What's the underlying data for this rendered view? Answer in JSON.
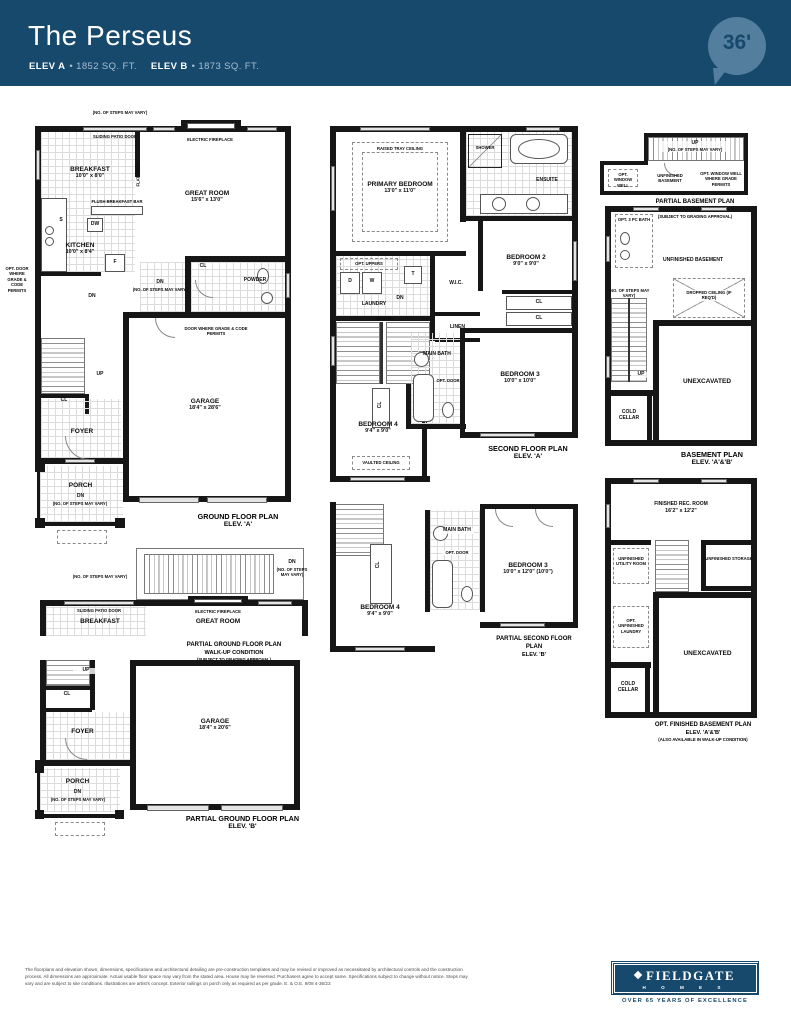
{
  "header": {
    "title": "The Perseus",
    "elev_a_label": "ELEV A",
    "elev_a_value": "• 1852 SQ. FT.",
    "elev_b_label": "ELEV B",
    "elev_b_value": "• 1873 SQ. FT.",
    "lot_badge": "36'"
  },
  "plans": {
    "ground_a": {
      "caption": [
        "GROUND FLOOR PLAN",
        "ELEV. 'A'"
      ],
      "labels": {
        "steps_note_top": "(NO. OF STEPS MAY VARY)",
        "sliding_patio_door": "SLIDING PATIO DOOR",
        "electric_fireplace": "ELECTRIC FIREPLACE",
        "breakfast_name": "BREAKFAST",
        "breakfast_dims": "10'0\" x 8'0\"",
        "flat_arch": "FLAT ARCH",
        "great_room_name": "GREAT ROOM",
        "great_room_dims": "15'6\" x 13'0\"",
        "flush_breakfast_bar": "FLUSH BREAKFAST BAR",
        "dw": "DW",
        "sink": "S",
        "fridge": "F",
        "kitchen_name": "KITCHEN",
        "kitchen_dims": "10'0\" x 8'4\"",
        "opt_door_note": "OPT. DOOR WHERE GRADE & CODE PERMITS",
        "closet_powder": "CL",
        "powder": "POWDER",
        "dn_mid": "DN",
        "dn_mid_note": "(NO. OF STEPS MAY VARY)",
        "garage_door_note": "DOOR WHERE GRADE & CODE PERMITS",
        "dn_stairs": "DN",
        "up_stairs": "UP",
        "closet_foyer": "CL",
        "foyer": "FOYER",
        "garage_name": "GARAGE",
        "garage_dims": "18'4\" x 28'6\"",
        "porch": "PORCH",
        "porch_dn": "DN",
        "porch_dn_note": "(NO. OF STEPS MAY VARY)"
      }
    },
    "second_a": {
      "caption": [
        "SECOND FLOOR PLAN",
        "ELEV. 'A'"
      ],
      "labels": {
        "raised_tray": "RAISED TRAY CEILING",
        "primary_name": "PRIMARY BEDROOM",
        "primary_dims": "13'0\" x 11'0\"",
        "shower": "SHOWER",
        "ensuite": "ENSUITE",
        "opt_uppers": "OPT. UPPERS",
        "dryer": "D",
        "washer": "W",
        "tub": "T",
        "laundry": "LAUNDRY",
        "wic": "W.I.C.",
        "linen": "LINEN",
        "bedroom2_name": "BEDROOM 2",
        "bedroom2_dims": "9'0\" x 9'0\"",
        "dn": "DN",
        "railing": "RAILING",
        "cl_stairs": "CL",
        "cl_b": "CL",
        "cl_c": "CL",
        "main_bath": "MAIN BATH",
        "opt_door": "OPT. DOOR",
        "bedroom3_name": "BEDROOM 3",
        "bedroom3_dims": "10'0\" x 10'0\"",
        "bedroom4_name": "BEDROOM 4",
        "bedroom4_dims": "9'4\" x 9'0\"",
        "vaulted": "VAULTED CEILING"
      }
    },
    "partial_basement_walkup": {
      "caption": [
        "PARTIAL BASEMENT PLAN",
        "WALK-UP CONDITION",
        "(SUBJECT TO GRADING APPROVAL)"
      ],
      "labels": {
        "up": "UP",
        "up_note": "(NO. OF STEPS MAY VARY)",
        "unfinished_basement": "UNFINISHED BASEMENT",
        "opt_window_well": "OPT. WINDOW WELL",
        "grade_note": "OPT. WINDOW WELL WHERE GRADE PERMITS"
      }
    },
    "basement": {
      "caption": [
        "BASEMENT PLAN",
        "ELEV. 'A'&'B'"
      ],
      "labels": {
        "opt_bath": "OPT. 3 PC BATH",
        "unfinished_basement": "UNFINISHED BASEMENT",
        "up": "UP",
        "up_note": "(NO. OF STEPS MAY VARY)",
        "dropped_ceiling": "DROPPED CEILING (IF REQ'D)",
        "unexcavated": "UNEXCAVATED",
        "cold_cellar": "COLD CELLAR"
      }
    },
    "partial_ground_walkup": {
      "caption": [
        "PARTIAL GROUND FLOOR PLAN",
        "WALK-UP CONDITION",
        "(SUBJECT TO GRADING APPROVAL)"
      ],
      "labels": {
        "steps_note": "(NO. OF STEPS MAY VARY)",
        "sliding_patio_door": "SLIDING PATIO DOOR",
        "breakfast": "BREAKFAST",
        "electric_fireplace": "ELECTRIC FIREPLACE",
        "great_room": "GREAT ROOM",
        "dn": "DN",
        "dn_note": "(NO. OF STEPS MAY VARY)"
      }
    },
    "partial_second_b": {
      "caption": [
        "PARTIAL SECOND FLOOR PLAN",
        "ELEV. 'B'"
      ],
      "labels": {
        "cl": "CL",
        "main_bath": "MAIN BATH",
        "opt_door": "OPT. DOOR",
        "bedroom3_name": "BEDROOM 3",
        "bedroom3_dims": "10'0\" x 12'0\" (10'0\")",
        "bedroom4_name": "BEDROOM 4",
        "bedroom4_dims": "9'4\" x 9'0\""
      }
    },
    "partial_ground_b": {
      "caption": [
        "PARTIAL GROUND FLOOR PLAN",
        "ELEV. 'B'"
      ],
      "labels": {
        "up": "UP",
        "cl": "CL",
        "foyer": "FOYER",
        "porch": "PORCH",
        "dn": "DN",
        "dn_note": "(NO. OF STEPS MAY VARY)",
        "garage_name": "GARAGE",
        "garage_dims": "18'4\" x 20'6\""
      }
    },
    "opt_finished_basement": {
      "caption": [
        "OPT. FINISHED BASEMENT PLAN",
        "ELEV. 'A'&'B'",
        "(ALSO AVAILABLE IN WALK-UP CONDITION)"
      ],
      "labels": {
        "rec_room_name": "FINISHED REC. ROOM",
        "rec_room_dims": "16'2\" x 12'2\"",
        "utility": "UNFINISHED UTILITY ROOM",
        "storage": "UNFINISHED STORAGE",
        "laundry": "OPT. UNFINISHED LAUNDRY",
        "unexcavated": "UNEXCAVATED",
        "cold_cellar": "COLD CELLAR"
      }
    }
  },
  "footer": {
    "disclaimer": "The floorplans and elevation shown, dimensions, specifications and architectural detailing are pre-construction templates and may be revised or improved as necessitated by architectural controls and the construction process. All dimensions are approximate. Actual usable floor space may vary from the stated area. House may be reversed. Purchasers agree to accept same. Specifications subject to change without notice. Steps may vary and are subject to site conditions. Illustrations are artist's concept. Exterior railings on porch only as required as per grade. E. & O.E. 9/08 4-36/23",
    "logo_name": "FIELDGATE",
    "logo_homes": "H O M E S",
    "logo_tagline": "OVER 65 YEARS OF EXCELLENCE"
  }
}
